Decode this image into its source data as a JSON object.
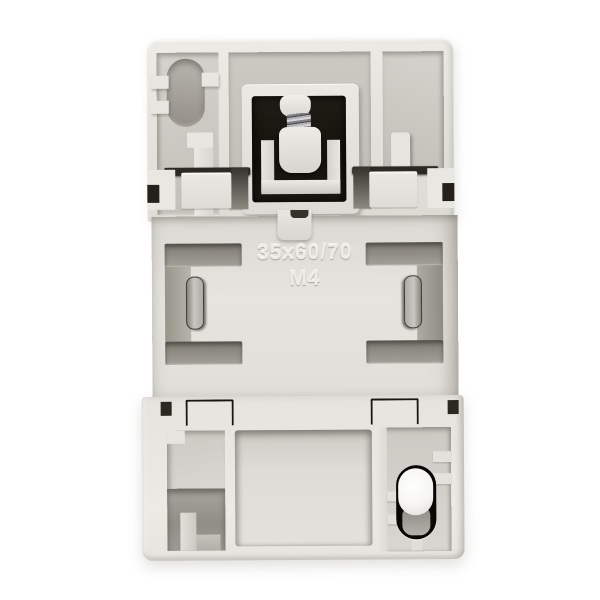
{
  "photo": {
    "subject": "Back view of a light-gray modular electrical device housing with a spring-loaded DIN rail mount, photographed on a white background",
    "background_color": "#ffffff"
  },
  "markings": {
    "line1": "35x60/70",
    "line2": "M4"
  },
  "colors": {
    "housing": "#e4e2dc",
    "housing_highlight": "#eeece7",
    "recess_gray": "#c6c3bd",
    "slot_shadow": "#8f8c84",
    "cavity_black": "#17140e",
    "spring_metal": "#8e8e92",
    "pin_white": "#fdfdfc"
  }
}
